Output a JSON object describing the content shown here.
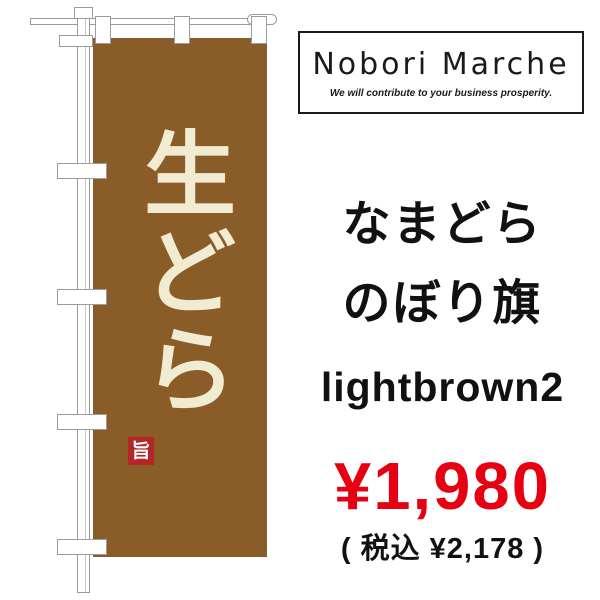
{
  "flag": {
    "vertical_title": "生どら",
    "chars": [
      "生",
      "ど",
      "ら"
    ],
    "seal_character": "旨",
    "colors": {
      "banner": "#8a5c28",
      "banner_text": "#f1ebd2",
      "seal": "#b2262a",
      "hardware_outline": "#9b9b9b"
    }
  },
  "logo_box": {
    "brand": "Nobori Marche",
    "tagline": "We will contribute to your business prosperity."
  },
  "product": {
    "name_line1": "なまどら",
    "name_line2": "のぼり旗",
    "color_variant": "lightbrown2",
    "price": "¥1,980",
    "tax_included": "( 税込 ¥2,178 )",
    "price_color": "#e60012"
  }
}
